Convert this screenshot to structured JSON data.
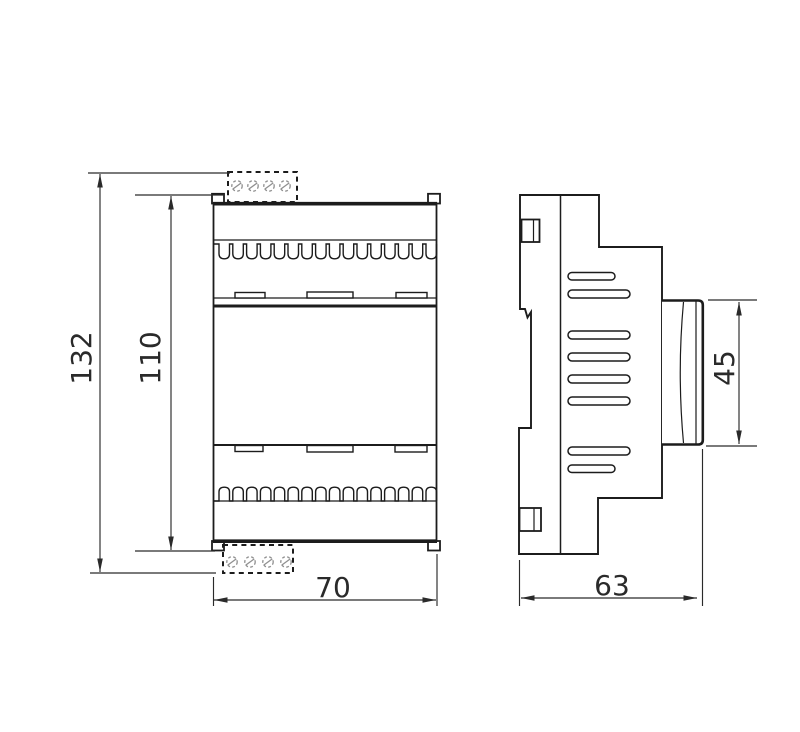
{
  "colors": {
    "background": "#ffffff",
    "line": "#1c1c1c",
    "dimension": "#2a2a2a",
    "screw": "#8f8f8f"
  },
  "front_view": {
    "terminal_count": 16,
    "connector_screw_count": 4,
    "latch_slot_count": 3,
    "dimensions": {
      "overall_height": "132",
      "body_height": "110",
      "width": "70"
    }
  },
  "side_view": {
    "vent_slot_count": 8,
    "dimensions": {
      "depth": "63",
      "front_panel_height": "45"
    }
  }
}
